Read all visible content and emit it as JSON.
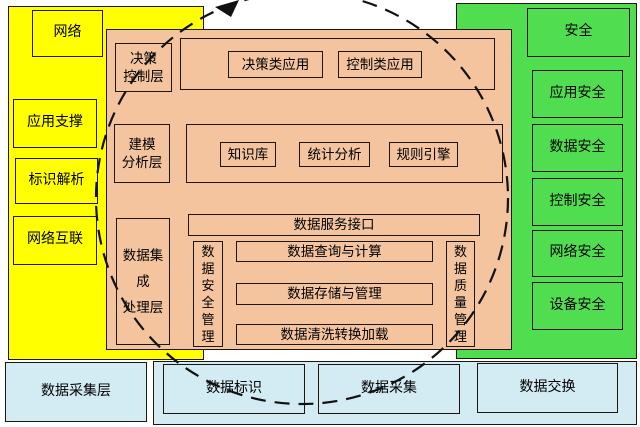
{
  "title": "industrial-platform-architecture-diagram",
  "colors": {
    "yellow": "#ffff00",
    "green": "#50dd50",
    "orange": "#f4c49f",
    "cyan": "#d3ebf2",
    "border": "#20150a",
    "line": "#111111"
  },
  "left": {
    "items": [
      "网络",
      "应用支撑",
      "标识解析",
      "网络互联"
    ]
  },
  "right": {
    "items": [
      "安全",
      "应用安全",
      "数据安全",
      "控制安全",
      "网络安全",
      "设备安全"
    ]
  },
  "center": {
    "decision": {
      "label": "决策\n控制层",
      "apps": [
        "决策类应用",
        "控制类应用"
      ]
    },
    "modeling": {
      "label": "建模\n分析层",
      "apps": [
        "知识库",
        "统计分析",
        "规则引擎"
      ]
    },
    "data": {
      "layer_label": "数据集\n成\n处理层",
      "service": "数据服务接口",
      "security": "数\n据\n安\n全\n管\n理",
      "quality": "数\n据\n质\n量\n管\n理",
      "rows": [
        "数据查询与计算",
        "数据存储与管理",
        "数据清洗转换加载"
      ]
    }
  },
  "bottom": {
    "layer": "数据采集层",
    "items": [
      "数据标识",
      "数据采集",
      "数据交换"
    ]
  }
}
